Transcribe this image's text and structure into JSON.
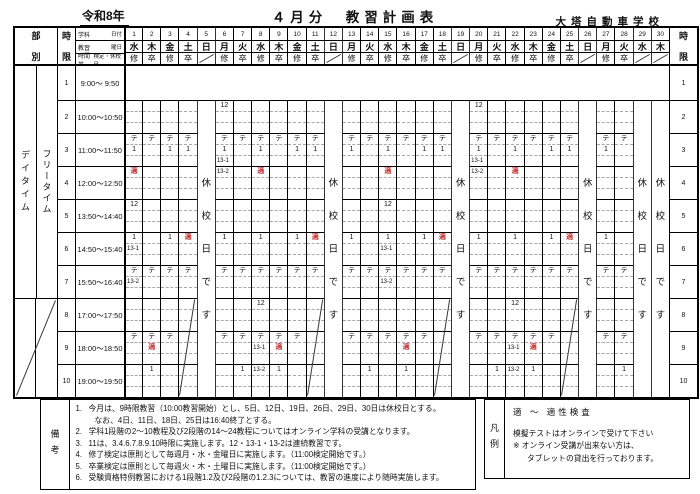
{
  "accent_red": "#c63636",
  "header": {
    "era": "令和8年",
    "title": "４月分　教習計画表",
    "school": "大塔自動車学校"
  },
  "grid": {
    "label_bubetsu": "部別",
    "label_jigen": "時限",
    "label_daytime": "デイタイム",
    "label_freetime": "フリータイム",
    "closed_text": "休校日です",
    "info_rows": [
      {
        "left": "学科",
        "right": "日付"
      },
      {
        "left": "教習",
        "right": "曜日"
      },
      {
        "left": "時間帯",
        "right": "検定・休校日"
      }
    ],
    "days": [
      {
        "n": 1,
        "dow": "水",
        "mark": "修",
        "type": "wd"
      },
      {
        "n": 2,
        "dow": "木",
        "mark": "卒",
        "type": "wd"
      },
      {
        "n": 3,
        "dow": "金",
        "mark": "修",
        "type": "wd"
      },
      {
        "n": 4,
        "dow": "土",
        "mark": "卒",
        "type": "sat"
      },
      {
        "n": 5,
        "dow": "日",
        "mark": "",
        "type": "closed"
      },
      {
        "n": 6,
        "dow": "月",
        "mark": "修",
        "type": "wd"
      },
      {
        "n": 7,
        "dow": "火",
        "mark": "卒",
        "type": "wd"
      },
      {
        "n": 8,
        "dow": "水",
        "mark": "修",
        "type": "wd"
      },
      {
        "n": 9,
        "dow": "木",
        "mark": "卒",
        "type": "wd"
      },
      {
        "n": 10,
        "dow": "金",
        "mark": "修",
        "type": "wd"
      },
      {
        "n": 11,
        "dow": "土",
        "mark": "卒",
        "type": "sat"
      },
      {
        "n": 12,
        "dow": "日",
        "mark": "",
        "type": "closed"
      },
      {
        "n": 13,
        "dow": "月",
        "mark": "修",
        "type": "wd"
      },
      {
        "n": 14,
        "dow": "火",
        "mark": "卒",
        "type": "wd"
      },
      {
        "n": 15,
        "dow": "水",
        "mark": "修",
        "type": "wd"
      },
      {
        "n": 16,
        "dow": "木",
        "mark": "卒",
        "type": "wd"
      },
      {
        "n": 17,
        "dow": "金",
        "mark": "修",
        "type": "wd"
      },
      {
        "n": 18,
        "dow": "土",
        "mark": "卒",
        "type": "sat"
      },
      {
        "n": 19,
        "dow": "日",
        "mark": "",
        "type": "closed"
      },
      {
        "n": 20,
        "dow": "月",
        "mark": "修",
        "type": "wd"
      },
      {
        "n": 21,
        "dow": "火",
        "mark": "卒",
        "type": "wd"
      },
      {
        "n": 22,
        "dow": "水",
        "mark": "修",
        "type": "wd"
      },
      {
        "n": 23,
        "dow": "木",
        "mark": "卒",
        "type": "wd"
      },
      {
        "n": 24,
        "dow": "金",
        "mark": "修",
        "type": "wd"
      },
      {
        "n": 25,
        "dow": "土",
        "mark": "卒",
        "type": "sat"
      },
      {
        "n": 26,
        "dow": "日",
        "mark": "",
        "type": "closed"
      },
      {
        "n": 27,
        "dow": "月",
        "mark": "修",
        "type": "wd"
      },
      {
        "n": 28,
        "dow": "火",
        "mark": "卒",
        "type": "wd"
      },
      {
        "n": 29,
        "dow": "水",
        "mark": "",
        "type": "closed"
      },
      {
        "n": 30,
        "dow": "木",
        "mark": "",
        "type": "closed"
      }
    ],
    "periods": [
      {
        "n": 1,
        "time": "9:00～ 9:50"
      },
      {
        "n": 2,
        "time": "10:00～10:50"
      },
      {
        "n": 3,
        "time": "11:00～11:50"
      },
      {
        "n": 4,
        "time": "12:00～12:50"
      },
      {
        "n": 5,
        "time": "13:50～14:40"
      },
      {
        "n": 6,
        "time": "14:50～15:40"
      },
      {
        "n": 7,
        "time": "15:50～16:40"
      },
      {
        "n": 8,
        "time": "17:00～17:50"
      },
      {
        "n": 9,
        "time": "18:00～18:50"
      },
      {
        "n": 10,
        "time": "19:00～19:50"
      }
    ],
    "cells": [
      [
        1,
        3,
        1,
        "テ",
        0
      ],
      [
        1,
        3,
        2,
        "1",
        0
      ],
      [
        1,
        4,
        1,
        "適",
        1
      ],
      [
        1,
        5,
        1,
        "12",
        0
      ],
      [
        1,
        6,
        1,
        "1",
        0
      ],
      [
        1,
        6,
        2,
        "13-1",
        0
      ],
      [
        1,
        7,
        1,
        "テ",
        0
      ],
      [
        1,
        7,
        2,
        "13-2",
        0
      ],
      [
        1,
        9,
        1,
        "テ",
        0
      ],
      [
        2,
        3,
        1,
        "テ",
        0
      ],
      [
        2,
        7,
        1,
        "テ",
        0
      ],
      [
        2,
        9,
        1,
        "テ",
        0
      ],
      [
        2,
        9,
        2,
        "適",
        1
      ],
      [
        2,
        10,
        1,
        "1",
        0
      ],
      [
        3,
        3,
        1,
        "テ",
        0
      ],
      [
        3,
        3,
        2,
        "1",
        0
      ],
      [
        3,
        6,
        1,
        "1",
        0
      ],
      [
        3,
        7,
        1,
        "テ",
        0
      ],
      [
        3,
        9,
        1,
        "テ",
        0
      ],
      [
        4,
        3,
        1,
        "テ",
        0
      ],
      [
        4,
        3,
        2,
        "1",
        0
      ],
      [
        4,
        6,
        1,
        "適",
        1
      ],
      [
        4,
        7,
        1,
        "テ",
        0
      ],
      [
        6,
        2,
        1,
        "12",
        0
      ],
      [
        6,
        3,
        1,
        "テ",
        0
      ],
      [
        6,
        3,
        2,
        "1",
        0
      ],
      [
        6,
        3,
        3,
        "13-1",
        0
      ],
      [
        6,
        4,
        1,
        "13-2",
        0
      ],
      [
        6,
        6,
        1,
        "1",
        0
      ],
      [
        6,
        7,
        1,
        "テ",
        0
      ],
      [
        6,
        9,
        1,
        "テ",
        0
      ],
      [
        7,
        3,
        1,
        "テ",
        0
      ],
      [
        7,
        7,
        1,
        "テ",
        0
      ],
      [
        7,
        9,
        1,
        "テ",
        0
      ],
      [
        7,
        10,
        1,
        "1",
        0
      ],
      [
        8,
        3,
        1,
        "テ",
        0
      ],
      [
        8,
        3,
        2,
        "1",
        0
      ],
      [
        8,
        4,
        1,
        "適",
        1
      ],
      [
        8,
        6,
        1,
        "1",
        0
      ],
      [
        8,
        7,
        1,
        "テ",
        0
      ],
      [
        8,
        8,
        1,
        "12",
        0
      ],
      [
        8,
        9,
        1,
        "テ",
        0
      ],
      [
        8,
        9,
        2,
        "13-1",
        0
      ],
      [
        8,
        10,
        1,
        "13-2",
        0
      ],
      [
        9,
        3,
        1,
        "テ",
        0
      ],
      [
        9,
        7,
        1,
        "テ",
        0
      ],
      [
        9,
        9,
        1,
        "テ",
        0
      ],
      [
        9,
        9,
        2,
        "適",
        1
      ],
      [
        9,
        10,
        1,
        "1",
        0
      ],
      [
        10,
        3,
        1,
        "テ",
        0
      ],
      [
        10,
        3,
        2,
        "1",
        0
      ],
      [
        10,
        6,
        1,
        "1",
        0
      ],
      [
        10,
        7,
        1,
        "テ",
        0
      ],
      [
        10,
        9,
        1,
        "テ",
        0
      ],
      [
        11,
        3,
        1,
        "テ",
        0
      ],
      [
        11,
        3,
        2,
        "1",
        0
      ],
      [
        11,
        6,
        1,
        "適",
        1
      ],
      [
        11,
        7,
        1,
        "テ",
        0
      ],
      [
        13,
        3,
        1,
        "テ",
        0
      ],
      [
        13,
        3,
        2,
        "1",
        0
      ],
      [
        13,
        6,
        1,
        "1",
        0
      ],
      [
        13,
        7,
        1,
        "テ",
        0
      ],
      [
        13,
        9,
        1,
        "テ",
        0
      ],
      [
        14,
        3,
        1,
        "テ",
        0
      ],
      [
        14,
        7,
        1,
        "テ",
        0
      ],
      [
        14,
        9,
        1,
        "テ",
        0
      ],
      [
        14,
        10,
        1,
        "1",
        0
      ],
      [
        15,
        3,
        1,
        "テ",
        0
      ],
      [
        15,
        3,
        2,
        "1",
        0
      ],
      [
        15,
        4,
        1,
        "適",
        1
      ],
      [
        15,
        5,
        1,
        "12",
        0
      ],
      [
        15,
        6,
        1,
        "1",
        0
      ],
      [
        15,
        6,
        2,
        "13-1",
        0
      ],
      [
        15,
        7,
        1,
        "テ",
        0
      ],
      [
        15,
        7,
        2,
        "13-2",
        0
      ],
      [
        15,
        9,
        1,
        "テ",
        0
      ],
      [
        16,
        3,
        1,
        "テ",
        0
      ],
      [
        16,
        7,
        1,
        "テ",
        0
      ],
      [
        16,
        9,
        1,
        "テ",
        0
      ],
      [
        16,
        9,
        2,
        "適",
        1
      ],
      [
        16,
        10,
        1,
        "1",
        0
      ],
      [
        17,
        3,
        1,
        "テ",
        0
      ],
      [
        17,
        3,
        2,
        "1",
        0
      ],
      [
        17,
        6,
        1,
        "1",
        0
      ],
      [
        17,
        7,
        1,
        "テ",
        0
      ],
      [
        17,
        9,
        1,
        "テ",
        0
      ],
      [
        18,
        3,
        1,
        "テ",
        0
      ],
      [
        18,
        3,
        2,
        "1",
        0
      ],
      [
        18,
        6,
        1,
        "適",
        1
      ],
      [
        18,
        7,
        1,
        "テ",
        0
      ],
      [
        20,
        2,
        1,
        "12",
        0
      ],
      [
        20,
        3,
        1,
        "テ",
        0
      ],
      [
        20,
        3,
        2,
        "1",
        0
      ],
      [
        20,
        3,
        3,
        "13-1",
        0
      ],
      [
        20,
        4,
        1,
        "13-2",
        0
      ],
      [
        20,
        6,
        1,
        "1",
        0
      ],
      [
        20,
        7,
        1,
        "テ",
        0
      ],
      [
        20,
        9,
        1,
        "テ",
        0
      ],
      [
        21,
        3,
        1,
        "テ",
        0
      ],
      [
        21,
        7,
        1,
        "テ",
        0
      ],
      [
        21,
        9,
        1,
        "テ",
        0
      ],
      [
        21,
        10,
        1,
        "1",
        0
      ],
      [
        22,
        3,
        1,
        "テ",
        0
      ],
      [
        22,
        3,
        2,
        "1",
        0
      ],
      [
        22,
        4,
        1,
        "適",
        1
      ],
      [
        22,
        6,
        1,
        "1",
        0
      ],
      [
        22,
        7,
        1,
        "テ",
        0
      ],
      [
        22,
        8,
        1,
        "12",
        0
      ],
      [
        22,
        9,
        1,
        "テ",
        0
      ],
      [
        22,
        9,
        2,
        "13-1",
        0
      ],
      [
        22,
        10,
        1,
        "13-2",
        0
      ],
      [
        23,
        3,
        1,
        "テ",
        0
      ],
      [
        23,
        7,
        1,
        "テ",
        0
      ],
      [
        23,
        9,
        1,
        "テ",
        0
      ],
      [
        23,
        9,
        2,
        "適",
        1
      ],
      [
        23,
        10,
        1,
        "1",
        0
      ],
      [
        24,
        3,
        1,
        "テ",
        0
      ],
      [
        24,
        3,
        2,
        "1",
        0
      ],
      [
        24,
        6,
        1,
        "1",
        0
      ],
      [
        24,
        7,
        1,
        "テ",
        0
      ],
      [
        24,
        9,
        1,
        "テ",
        0
      ],
      [
        25,
        3,
        1,
        "テ",
        0
      ],
      [
        25,
        3,
        2,
        "1",
        0
      ],
      [
        25,
        6,
        1,
        "適",
        1
      ],
      [
        25,
        7,
        1,
        "テ",
        0
      ],
      [
        27,
        3,
        1,
        "テ",
        0
      ],
      [
        27,
        3,
        2,
        "1",
        0
      ],
      [
        27,
        6,
        1,
        "1",
        0
      ],
      [
        27,
        7,
        1,
        "テ",
        0
      ],
      [
        27,
        9,
        1,
        "テ",
        0
      ],
      [
        28,
        3,
        1,
        "テ",
        0
      ],
      [
        28,
        7,
        1,
        "テ",
        0
      ],
      [
        28,
        9,
        1,
        "テ",
        0
      ],
      [
        28,
        10,
        1,
        "1",
        0
      ]
    ]
  },
  "remarks": {
    "label": "備考",
    "items": [
      {
        "num": "1.",
        "lines": [
          "今月は、9時限教習（10:00教習開始）とし、5日、12日、19日、26日、29日、30日は休校日とする。",
          "なお、4日、11日、18日、25日は16:40終了とする。"
        ]
      },
      {
        "num": "2.",
        "lines": [
          "学科1段階の2～10教程及び2段階の14～24教程についてはオンライン学科の受講となります。"
        ]
      },
      {
        "num": "3.",
        "lines": [
          "11は、3.4.6.7.8.9.10時限に実施します。12・13-1・13-2は連続教習です。"
        ]
      },
      {
        "num": "4.",
        "lines": [
          "修了検定は原則として毎週月・水・金曜日に実施します。（11:00検定開始です。）"
        ]
      },
      {
        "num": "5.",
        "lines": [
          "卒業検定は原則として毎週火・木・土曜日に実施します。（11:00検定開始です。）"
        ]
      },
      {
        "num": "6.",
        "lines": [
          "受験資格特例教習における1段階1.2及び2段階の1.2.3については、教習の進度により随時実施します。"
        ]
      }
    ]
  },
  "legend": {
    "label": "凡例",
    "rule": "適 ～ 適性検査",
    "lines": [
      "模擬テストはオンラインで受けて下さい",
      "※ オンライン受講が出来ない方は、",
      "タブレットの貸出を行っております。"
    ]
  }
}
